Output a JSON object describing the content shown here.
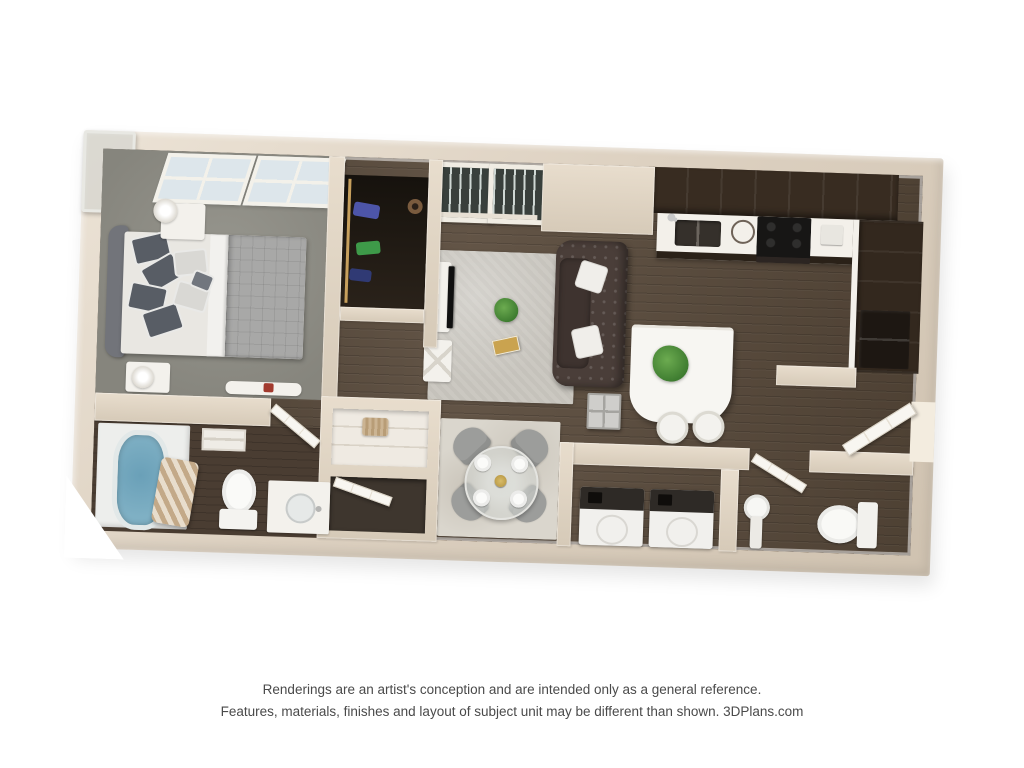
{
  "page": {
    "background_color": "#ffffff"
  },
  "floorplan": {
    "type": "3d-floor-plan-rendering",
    "description_names": "top-down 3D apartment unit rendering",
    "colors": {
      "wall": "#ddd1c1",
      "wall_highlight": "#ece3d6",
      "wood_floor": "#594a3b",
      "bedroom_carpet": "#8e8d85",
      "living_rug": "#cbc8c1",
      "dining_rug": "#dad6cd",
      "sofa": "#4a3e39",
      "cabinets": "#382c21",
      "countertop": "#f3f0ea",
      "tub_water": "#7fb0c4",
      "plant_green": "#4e8f3a",
      "fixture_white": "#f6f5f1"
    },
    "rooms": [
      {
        "name": "bedroom",
        "objects": [
          "bed",
          "headboard",
          "pillows",
          "nightstands",
          "lamps",
          "windows",
          "foot-bench"
        ]
      },
      {
        "name": "walk-in-closet",
        "objects": [
          "hanging-clothes",
          "closet-rod"
        ]
      },
      {
        "name": "entry-french-doors",
        "objects": [
          "double-glass-doors"
        ]
      },
      {
        "name": "living-room",
        "objects": [
          "tufted-sofa",
          "throw-pillows",
          "glass-coffee-table",
          "plant",
          "tv-stand",
          "tv",
          "side-table",
          "cube-table",
          "area-rug"
        ]
      },
      {
        "name": "kitchen",
        "objects": [
          "upper-cabinets",
          "countertop",
          "double-sink",
          "faucet",
          "stove",
          "refrigerator",
          "breakfast-bar",
          "bar-plant",
          "stools"
        ]
      },
      {
        "name": "dining-area",
        "objects": [
          "round-glass-table",
          "four-chairs",
          "four-plates",
          "centerpiece",
          "rug"
        ]
      },
      {
        "name": "bathroom",
        "objects": [
          "bathtub",
          "shower-curtain",
          "toilet",
          "vanity-sink",
          "ceiling-vent",
          "door"
        ]
      },
      {
        "name": "hall-closets",
        "objects": [
          "linen-shelves",
          "basket",
          "closet-door"
        ]
      },
      {
        "name": "laundry-closet",
        "objects": [
          "washer",
          "dryer"
        ]
      },
      {
        "name": "bathroom-2",
        "objects": [
          "pedestal-sink",
          "toilet",
          "door"
        ]
      },
      {
        "name": "entry",
        "objects": [
          "entry-door",
          "door-opening"
        ]
      }
    ]
  },
  "disclaimer": {
    "line1": "Renderings are an artist's conception and are intended only as a general reference.",
    "line2": "Features, materials, finishes and layout of subject unit may be different than shown. 3DPlans.com"
  }
}
